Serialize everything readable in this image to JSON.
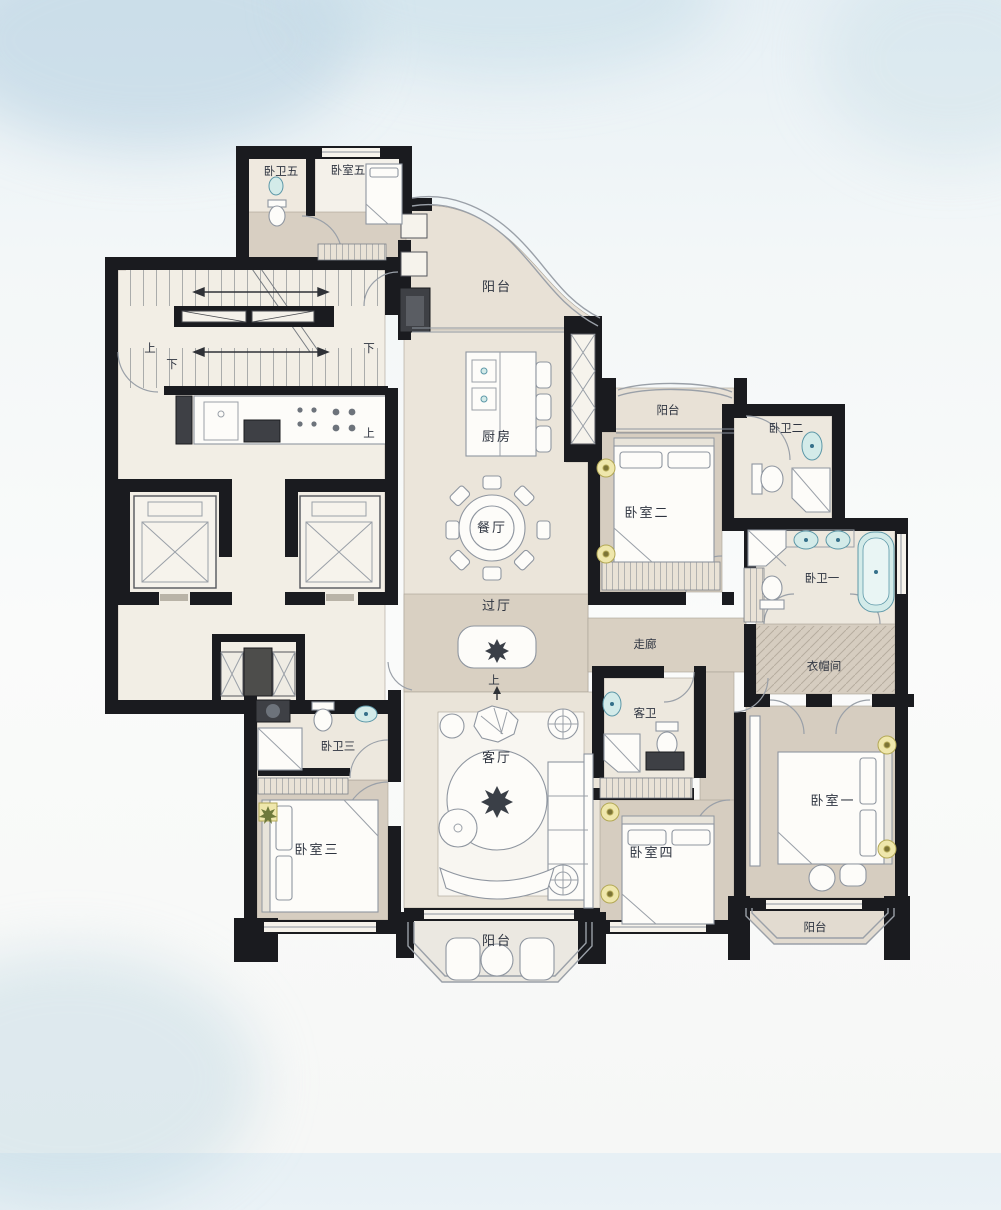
{
  "plan": {
    "rooms": {
      "bath5": "卧卫五",
      "bedroom5": "卧室五",
      "balcony_top": "阳台",
      "kitchen": "厨房",
      "balcony2": "阳台",
      "bath2": "卧卫二",
      "bedroom2": "卧室二",
      "dining": "餐厅",
      "bath1": "卧卫一",
      "foyer": "过厅",
      "corridor": "走廊",
      "cloakroom": "衣帽间",
      "guest_bath": "客卫",
      "bath3": "卧卫三",
      "living": "客厅",
      "bedroom3": "卧室三",
      "bedroom4": "卧室四",
      "bedroom1": "卧室一",
      "balcony_bottom": "阳台",
      "balcony_right": "阳台"
    },
    "stairs": {
      "up": "上",
      "down": "下"
    },
    "colors": {
      "wall": "#1a1b1f",
      "floor_cream": "#ebe5da",
      "floor_taupe": "#d6cdc0",
      "floor_light": "#f1ece2",
      "fixture_cyan": "#d3ebe9",
      "accent_yellow": "#efe7ac",
      "background": "#e7f0f5",
      "label": "#2e3440"
    }
  }
}
